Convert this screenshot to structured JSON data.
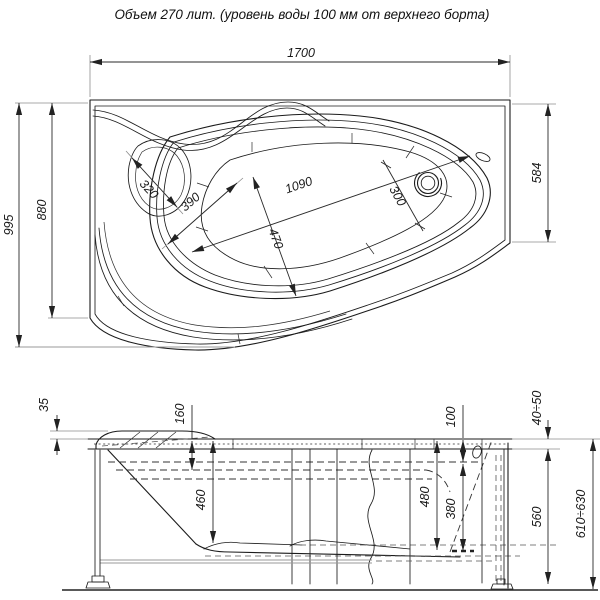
{
  "title": "Объем 270 лит. (уровень воды 100 мм от верхнего борта)",
  "plan_view": {
    "dims": {
      "overall_length": "1700",
      "overall_width": "995",
      "inner_width": "880",
      "right_width": "584",
      "headrest_width": "320",
      "seat_length": "390",
      "well_length": "1090",
      "well_width": "470",
      "drain_zone_width": "300"
    }
  },
  "side_view": {
    "dims": {
      "headrest_height": "35",
      "seat_depth": "160",
      "bowl_depth": "460",
      "water_level_from_rim": "100",
      "depth_at_drain": "480",
      "water_depth": "380",
      "rim_height_range": "40÷50",
      "body_height": "560",
      "overall_height_range": "610÷630"
    }
  }
}
